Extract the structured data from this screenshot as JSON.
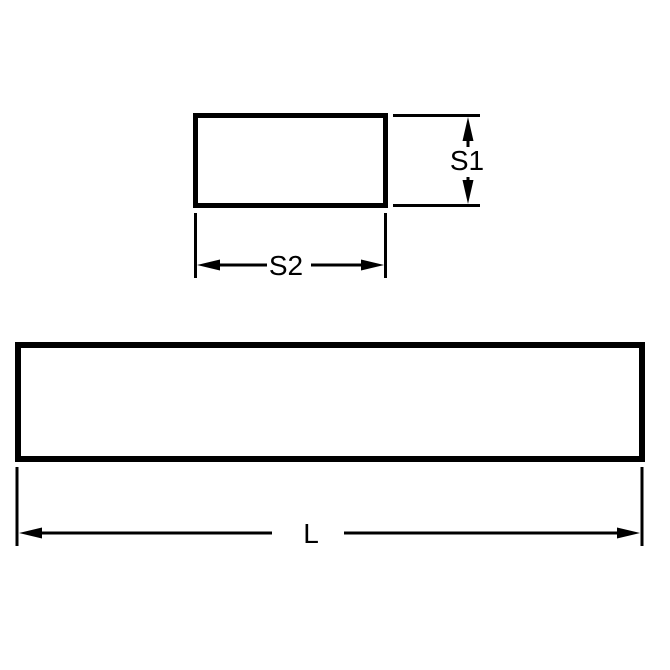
{
  "diagram": {
    "background_color": "#ffffff",
    "line_color": "#000000",
    "cross_section_view": {
      "height_label": "S1",
      "width_label": "S2"
    },
    "side_view": {
      "length_label": "L"
    }
  }
}
